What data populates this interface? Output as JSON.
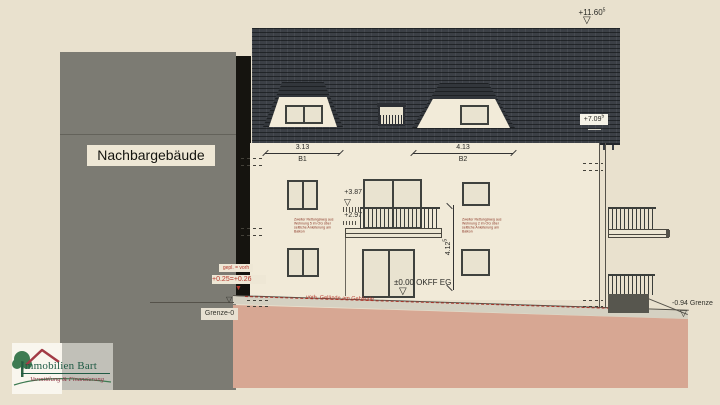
{
  "drawing": {
    "neighbor_label": "Nachbargebäude",
    "levels": {
      "ridge": "+11.60",
      "ridge_sup": "5",
      "eaves": "+7.09",
      "eaves_sup": "5",
      "og": "+3.87",
      "balcony": "+2.97",
      "eg": "±0.00 OKFF EG",
      "gepl": "gepl. = vorh",
      "gepl_left": "+0.25",
      "gepl_right": "+0.26",
      "grenze_left": "Grenze-0",
      "grenze_right": "-0.94 Grenze"
    },
    "dims": {
      "b1": "3.13",
      "b1_label": "B1",
      "b2": "4.13",
      "b2_label": "B2",
      "height": "4.12",
      "height_sup": "5"
    },
    "notes": {
      "gelaende": "vorh. Gelände am Gebäude",
      "rescue_left_1": "Zweiter Rettungsweg aus",
      "rescue_left_2": "Wohnung 5 im OG über",
      "rescue_left_3": "seitliche Anleiterung am Balkon",
      "rescue_right_1": "Zweiter Rettungsweg aus",
      "rescue_right_2": "Wohnung 2 im OG über",
      "rescue_right_3": "seitliche Anleiterung am Balkon"
    }
  },
  "logo": {
    "title": "Immobilien Bart",
    "subtitle": "Vermittlung & Finanzierung"
  },
  "colors": {
    "background": "#e9e1ce",
    "roof": "#3c4046",
    "facade": "#f1ead8",
    "neighbor_gray": "#7c7b73",
    "ground_pink": "#d7a793",
    "annotation_red": "#b5382c",
    "logo_green": "#1f5a44",
    "logo_maroon": "#8b3040"
  }
}
